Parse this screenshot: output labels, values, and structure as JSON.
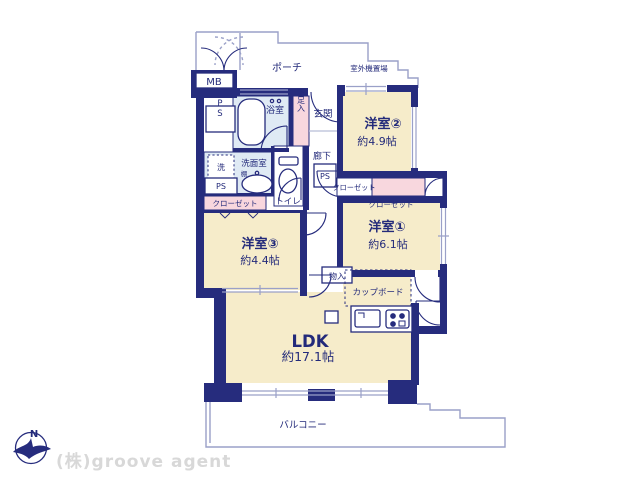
{
  "plan": {
    "rooms": {
      "western2": {
        "label": "洋室②",
        "area": "約4.9帖"
      },
      "western1": {
        "label": "洋室①",
        "area": "約6.1帖"
      },
      "western3": {
        "label": "洋室③",
        "area": "約4.4帖"
      },
      "ldk": {
        "label": "LDK",
        "area": "約17.1帖"
      }
    },
    "labels": {
      "porch": "ポーチ",
      "outdoor_unit": "室外機置場",
      "meter_box": "MB",
      "pipe_space": "PS",
      "bathroom": "浴室",
      "shoe_cabinet": "下足入",
      "entrance": "玄関",
      "hallway": "廊下",
      "washer": "洗",
      "washroom": "洗面室",
      "shelf": "棚",
      "toilet": "トイレ",
      "closet": "クローゼット",
      "storage": "物入",
      "cupboard": "カップボード",
      "balcony": "バルコニー"
    },
    "compass": {
      "north": "N"
    }
  },
  "footer": {
    "company": "(株)groove agent"
  },
  "colors": {
    "wall": "#262c7d",
    "room_cream": "#f6ecca",
    "wet_blue": "#dfeaf4",
    "closet_pink": "#f8d7de",
    "outline": "#9aa0c8",
    "text": "#232a7a",
    "logo_gray": "#d8d8d8"
  }
}
